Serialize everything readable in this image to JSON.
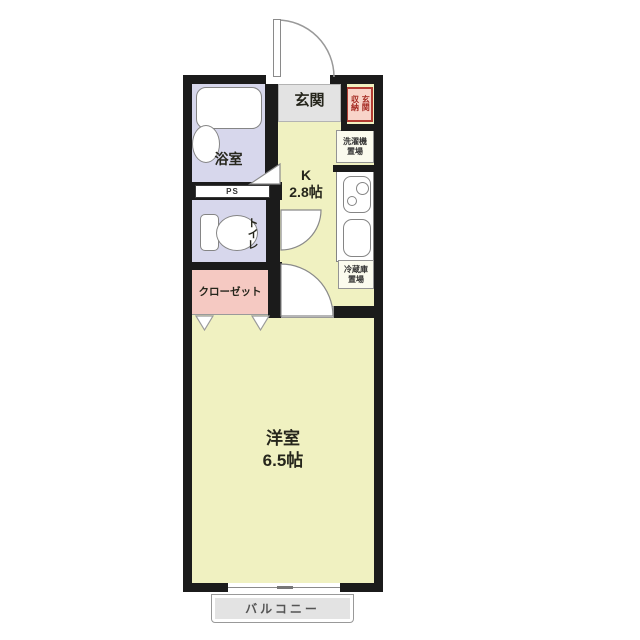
{
  "plan": {
    "type": "floor-plan",
    "rooms": {
      "entrance": {
        "label": "玄関"
      },
      "entrance_storage": {
        "label": "玄関収納"
      },
      "bathroom": {
        "label": "浴室"
      },
      "pipe_space": {
        "label": "PS"
      },
      "toilet": {
        "label": "トイレ"
      },
      "closet": {
        "label": "クローゼット"
      },
      "kitchen": {
        "label": "K",
        "size": "2.8帖"
      },
      "washer_space": {
        "line1": "洗濯機",
        "line2": "置場"
      },
      "fridge_space": {
        "line1": "冷蔵庫",
        "line2": "置場"
      },
      "main_room": {
        "label": "洋室",
        "size": "6.5帖"
      },
      "balcony": {
        "label": "バルコニー"
      }
    },
    "colors": {
      "wall": "#1b1b1b",
      "floor_main": "#f0f1c1",
      "floor_wet": "#d7d7ec",
      "floor_closet": "#f5c9c2",
      "floor_entrance": "#e3e3e3",
      "balcony_fill": "#e3e3e3",
      "storage_accent": "#b23b32",
      "fixture_line": "#858585",
      "text": "#26261c"
    }
  }
}
